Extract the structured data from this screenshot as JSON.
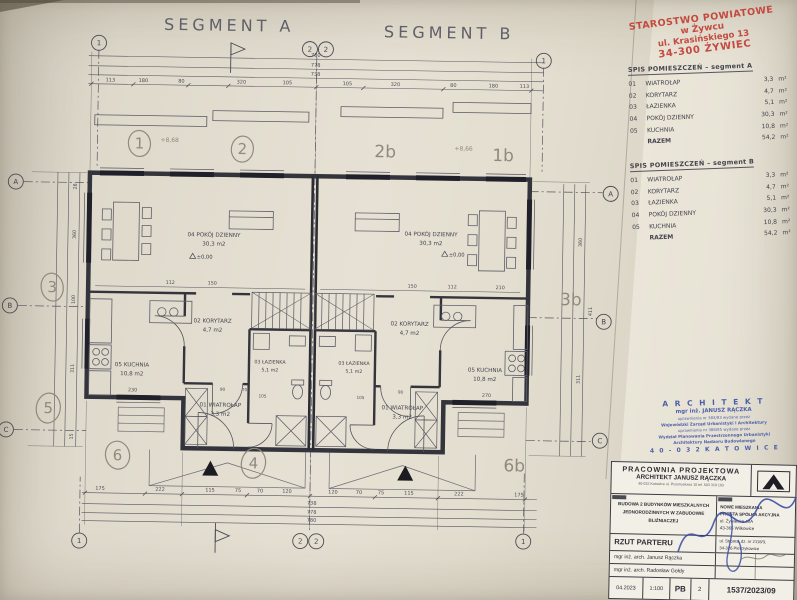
{
  "sheet": {
    "segment_a_title": "SEGMENT A",
    "segment_b_title": "SEGMENT B"
  },
  "approval_stamp": {
    "line1": "STAROSTWO POWIATOWE",
    "line2": "w Żywcu",
    "line3": "ul. Krasińskiego 13",
    "line4": "34-300 ŻYWIEC"
  },
  "schedule_a": {
    "title": "SPIS POMIESZCZEŃ  –  segment A",
    "rows": [
      {
        "no": "01",
        "name": "WIATROŁAP",
        "area": "3,3",
        "unit": "m²"
      },
      {
        "no": "02",
        "name": "KORYTARZ",
        "area": "4,7",
        "unit": "m²"
      },
      {
        "no": "03",
        "name": "ŁAZIENKA",
        "area": "5,1",
        "unit": "m²"
      },
      {
        "no": "04",
        "name": "POKÓJ DZIENNY",
        "area": "30,3",
        "unit": "m²"
      },
      {
        "no": "05",
        "name": "KUCHNIA",
        "area": "10,8",
        "unit": "m²"
      }
    ],
    "total_label": "RAZEM",
    "total_area": "54,2",
    "total_unit": "m²"
  },
  "schedule_b": {
    "title": "SPIS POMIESZCZEŃ  –  segment B",
    "rows": [
      {
        "no": "01",
        "name": "WIATROŁAP",
        "area": "3,3",
        "unit": "m²"
      },
      {
        "no": "02",
        "name": "KORYTARZ",
        "area": "4,7",
        "unit": "m²"
      },
      {
        "no": "03",
        "name": "ŁAZIENKA",
        "area": "5,1",
        "unit": "m²"
      },
      {
        "no": "04",
        "name": "POKÓJ DZIENNY",
        "area": "30,3",
        "unit": "m²"
      },
      {
        "no": "05",
        "name": "KUCHNIA",
        "area": "10,8",
        "unit": "m²"
      }
    ],
    "total_label": "RAZEM",
    "total_area": "54,2",
    "total_unit": "m²"
  },
  "architect_stamp": {
    "line1": "A R C H I T E K T",
    "line2": "mgr inż. JANUSZ RĄCZKA",
    "line3": "uprawnienia nr 383/83 wydane przez",
    "line4": "Wojewódzki Zarząd Urbanistyki i Architektury",
    "line5": "uprawnienia nr 388/85 wydane przez",
    "line6": "Wydział Planowania Przestrzennego Urbanistyki",
    "line7": "Architektury Nadzoru Budowlanego",
    "line8": "4 0 - 0 3 2  K A T O W I C E"
  },
  "title_block": {
    "studio_name": "PRACOWNIA PROJEKTOWA",
    "studio_architect": "ARCHITEKT JANUSZ RĄCZKA",
    "studio_address": "40-032 Katowice ul. Przemysłowa 10 tel. 503 319 193",
    "project_line1": "BUDOWA 2 BUDYNKÓW MIESZKALNYCH",
    "project_line2": "JEDNORODZINNYCH W ZABUDOWIE",
    "project_line3": "BLIŹNIACZEJ",
    "investor_line1": "NOWE MIESZKANIA",
    "investor_line2": "PROSTA SPÓŁKA AKCYJNA",
    "investor_line3": "ul. Żywiecka 40A",
    "investor_line4": "43-365 Wilkowice",
    "location_line1": "ul. Stroma, dz. nr 2118/3,",
    "location_line2": "34-326 Pietrzykowice",
    "drawing_title": "RZUT PARTERU",
    "designer": "mgr inż. arch. Janusz Rączka",
    "designer2": "mgr inż. arch. Radosław Gołdy",
    "date": "04.2023",
    "scale": "1:100",
    "stage": "PB",
    "sheet_no": "2",
    "drawing_no": "1537/2023/09"
  },
  "plan": {
    "rooms": {
      "living_label": "04 POKÓJ DZIENNY",
      "living_area": "30,3 m2",
      "kitchen_label": "05 KUCHNIA",
      "kitchen_area": "10,8 m2",
      "corridor_label": "02 KORYTARZ",
      "corridor_area": "4,7 m2",
      "bath_label": "03 ŁAZIENKA",
      "bath_area": "5,1 m2",
      "vestibule_label": "01 WIATROŁAP",
      "vestibule_area": "3,3 m2"
    },
    "level_mark": "±0,00",
    "axes": {
      "a": "A",
      "b": "B",
      "c": "C",
      "n1": "1",
      "n2": "2"
    },
    "dims": {
      "total_1": "780",
      "total_2": "778",
      "total_3": "738",
      "top_chain": [
        "113",
        "180",
        "80",
        "320",
        "105"
      ],
      "bottom_chain": [
        "175",
        "222",
        "115",
        "75",
        "70",
        "120"
      ],
      "left_chain": [
        "28",
        "360",
        "100",
        "311",
        "15"
      ],
      "right_chain": [
        "360",
        "411",
        "311"
      ],
      "inner": [
        "112",
        "150",
        "210",
        "230",
        "270",
        "105",
        "90",
        "70"
      ]
    },
    "annotations": {
      "c1": "1",
      "c2": "2",
      "t2b": "2b",
      "t1b": "1b",
      "c3": "3",
      "c5": "5",
      "t3b": "3b",
      "c6": "6",
      "c4": "4",
      "t6b": "6b",
      "lv1": "+8,68",
      "lv2": "+8,66"
    }
  }
}
